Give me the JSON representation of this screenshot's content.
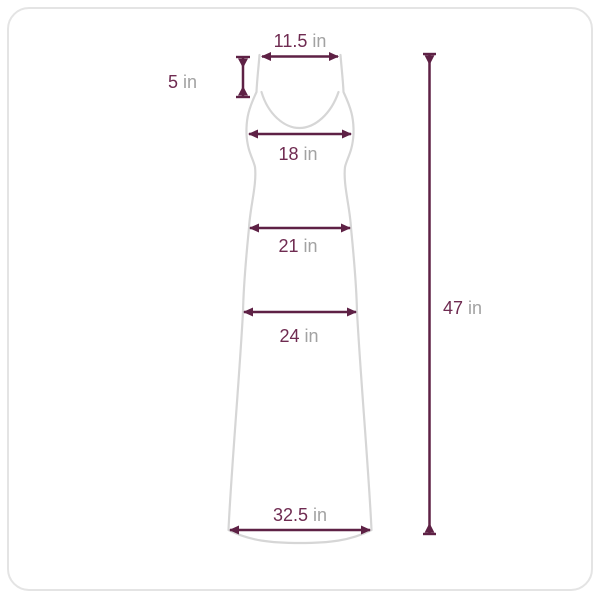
{
  "diagram": {
    "kind": "garment-size-diagram",
    "garment": "dress",
    "measurements": {
      "top_width": {
        "value": "11.5",
        "unit": "in"
      },
      "strap_drop": {
        "value": "5",
        "unit": "in"
      },
      "bust": {
        "value": "18",
        "unit": "in"
      },
      "waist": {
        "value": "21",
        "unit": "in"
      },
      "hip": {
        "value": "24",
        "unit": "in"
      },
      "hem": {
        "value": "32.5",
        "unit": "in"
      },
      "length": {
        "value": "47",
        "unit": "in"
      }
    },
    "colors": {
      "dimension_line": "#5e2145",
      "value_text": "#6f2b51",
      "unit_text": "#a2a2a2",
      "garment_outline": "#d6d6d6",
      "frame_border": "#e4e4e4",
      "background": "#ffffff"
    }
  }
}
